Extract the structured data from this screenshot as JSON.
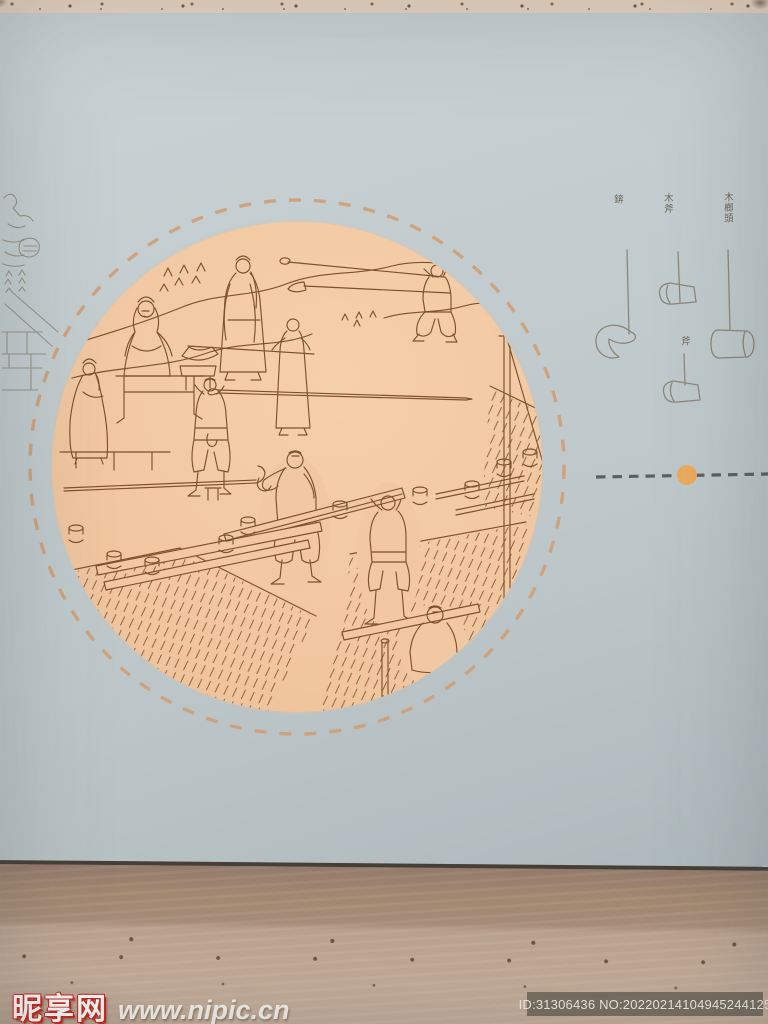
{
  "panel": {
    "colors": {
      "board": "#c2cbcd",
      "disc": "#f1c8a1",
      "illustration_ink": "#7d5130",
      "ring_dash": "#cf9e76",
      "tool_ink": "#8d8779",
      "label_ink": "#6d6858",
      "divider_dash": "#5c6062",
      "divider_dot": "#eaaa5e"
    },
    "tools": {
      "items": [
        {
          "label": "錛",
          "name": "adze"
        },
        {
          "label": "木斧",
          "name": "wood-axe"
        },
        {
          "label": "斧",
          "name": "axe"
        },
        {
          "label": "木榔頭",
          "name": "wooden-mallet"
        }
      ]
    }
  },
  "watermark": {
    "site_name": "昵享网",
    "site_url": "www.nipic.cn",
    "accent": "#c9271e"
  },
  "id_badge": {
    "text": "ID:31306436 NO:20220214104945244125"
  }
}
